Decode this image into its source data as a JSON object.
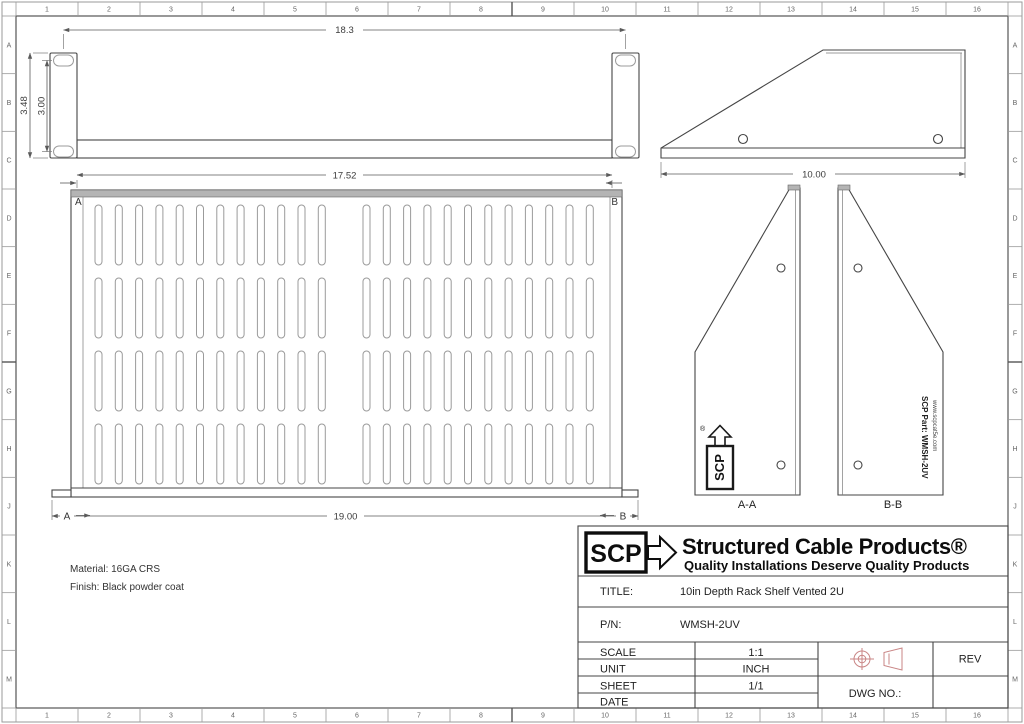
{
  "sheet": {
    "grid_cols": [
      "1",
      "2",
      "3",
      "4",
      "5",
      "6",
      "7",
      "8",
      "9",
      "10",
      "11",
      "12",
      "13",
      "14",
      "15",
      "16"
    ],
    "grid_rows": [
      "A",
      "B",
      "C",
      "D",
      "E",
      "F",
      "G",
      "H",
      "J",
      "K",
      "L",
      "M"
    ]
  },
  "views": {
    "front": {
      "dim_hole_span": "18.3",
      "dim_overall_height": "3.48",
      "dim_hole_spacing": "3.00"
    },
    "plan": {
      "dim_inner_width": "17.52",
      "dim_overall_width": "19.00",
      "corner_a": "A",
      "corner_b": "B",
      "cut_a": "A",
      "cut_b": "B",
      "slot_rows": 4,
      "slot_groups": 2,
      "slot_cols_per_group": 12
    },
    "side": {
      "dim_depth": "10.00"
    },
    "section_a": {
      "label": "A-A",
      "logo_text": "SCP",
      "logo_reg": "®"
    },
    "section_b": {
      "label": "B-B",
      "part_text": "SCP Part: WMSH-2UV",
      "url_text": "www.scpcat5e.com"
    }
  },
  "notes": {
    "material": "Material: 16GA CRS",
    "finish": "Finish: Black powder coat"
  },
  "title_block": {
    "logo_scp": "SCP",
    "brand": "Structured Cable Products®",
    "tagline": "Quality Installations Deserve Quality Products",
    "title_label": "TITLE:",
    "title_value": "10in Depth Rack Shelf Vented 2U",
    "pn_label": "P/N:",
    "pn_value": "WMSH-2UV",
    "rows": [
      {
        "label": "SCALE",
        "value": "1:1"
      },
      {
        "label": "UNIT",
        "value": "INCH"
      },
      {
        "label": "SHEET",
        "value": "1/1"
      },
      {
        "label": "DATE",
        "value": ""
      }
    ],
    "rev_label": "REV",
    "dwg_label": "DWG NO.:"
  },
  "colors": {
    "line": "#454545",
    "slot": "#9b9b9b",
    "cut_band": "#b4b4b4",
    "projection_symbol": "#c98585",
    "paper": "#ffffff"
  }
}
